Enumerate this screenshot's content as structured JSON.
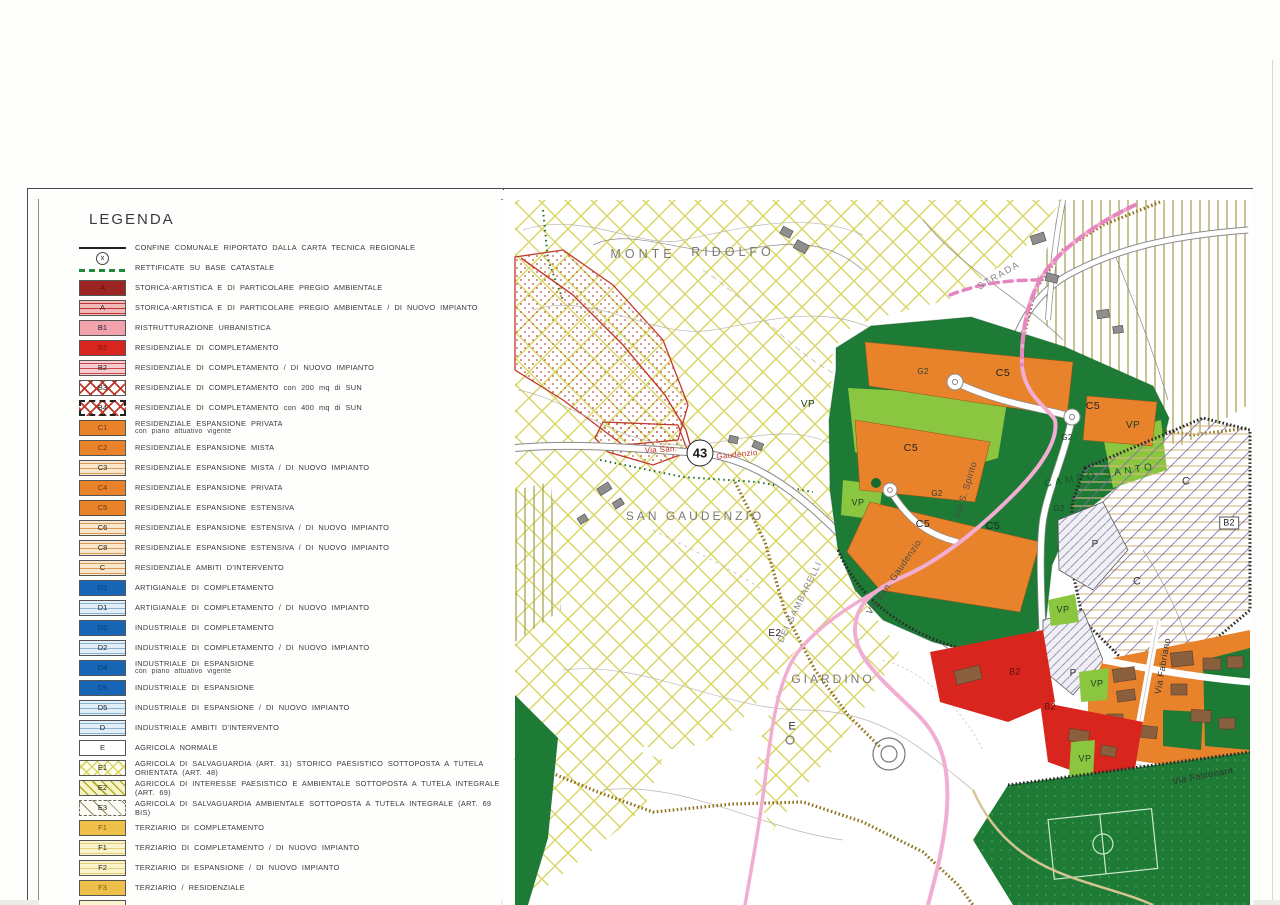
{
  "legend": {
    "title": "LEGENDA",
    "items": [
      {
        "code": "",
        "style": "line",
        "label": "CONFINE COMUNALE RIPORTATO DALLA CARTA TECNICA REGIONALE",
        "label2": ""
      },
      {
        "code": "x",
        "style": "dash-green",
        "label": "RETTIFICATE SU BASE CATASTALE",
        "label2": ""
      },
      {
        "code": "A",
        "style": "solid-darkred",
        "label": "STORICA-ARTISTICA E DI PARTICOLARE PREGIO AMBIENTALE",
        "label2": ""
      },
      {
        "code": "A",
        "style": "stripe-red",
        "label": "STORICA-ARTISTICA E DI PARTICOLARE PREGIO AMBIENTALE / DI NUOVO IMPIANTO",
        "label2": ""
      },
      {
        "code": "B1",
        "style": "solid-pink",
        "label": "RISTRUTTURAZIONE URBANISTICA",
        "label2": ""
      },
      {
        "code": "B2",
        "style": "solid-red",
        "label": "RESIDENZIALE DI COMPLETAMENTO",
        "label2": ""
      },
      {
        "code": "B2",
        "style": "stripe-pink",
        "label": "RESIDENZIALE DI COMPLETAMENTO / DI NUOVO IMPIANTO",
        "label2": ""
      },
      {
        "code": "B3",
        "style": "cross-red",
        "label": "RESIDENZIALE DI COMPLETAMENTO con 200 mq di SUN",
        "label2": ""
      },
      {
        "code": "B4",
        "style": "cross-red-border",
        "label": "RESIDENZIALE DI COMPLETAMENTO con 400 mq di SUN",
        "label2": ""
      },
      {
        "code": "C1",
        "style": "solid-orange",
        "label": "RESIDENZIALE ESPANSIONE PRIVATA",
        "label2": "con piano attuativo vigente"
      },
      {
        "code": "C2",
        "style": "solid-orange",
        "label": "RESIDENZIALE ESPANSIONE MISTA",
        "label2": ""
      },
      {
        "code": "C3",
        "style": "stripe-orange",
        "label": "RESIDENZIALE ESPANSIONE MISTA / DI NUOVO IMPIANTO",
        "label2": ""
      },
      {
        "code": "C4",
        "style": "solid-orange",
        "label": "RESIDENZIALE ESPANSIONE PRIVATA",
        "label2": ""
      },
      {
        "code": "C5",
        "style": "solid-orange",
        "label": "RESIDENZIALE ESPANSIONE ESTENSIVA",
        "label2": ""
      },
      {
        "code": "C6",
        "style": "stripe-orange",
        "label": "RESIDENZIALE ESPANSIONE ESTENSIVA / DI NUOVO IMPIANTO",
        "label2": ""
      },
      {
        "code": "C8",
        "style": "stripe-orange",
        "label": "RESIDENZIALE ESPANSIONE ESTENSIVA / DI NUOVO IMPIANTO",
        "label2": ""
      },
      {
        "code": "C",
        "style": "stripe-orange",
        "label": "RESIDENZIALE AMBITI D'INTERVENTO",
        "label2": ""
      },
      {
        "code": "D1",
        "style": "solid-blue",
        "label": "ARTIGIANALE DI COMPLETAMENTO",
        "label2": ""
      },
      {
        "code": "D1",
        "style": "stripe-blue",
        "label": "ARTIGIANALE DI COMPLETAMENTO / DI NUOVO IMPIANTO",
        "label2": ""
      },
      {
        "code": "D2",
        "style": "solid-blue",
        "label": "INDUSTRIALE DI COMPLETAMENTO",
        "label2": ""
      },
      {
        "code": "D2",
        "style": "stripe-blue",
        "label": "INDUSTRIALE DI COMPLETAMENTO / DI NUOVO IMPIANTO",
        "label2": ""
      },
      {
        "code": "D4",
        "style": "solid-blue",
        "label": "INDUSTRIALE DI ESPANSIONE",
        "label2": "con piano attuativo vigente"
      },
      {
        "code": "D5",
        "style": "solid-blue",
        "label": "INDUSTRIALE DI ESPANSIONE",
        "label2": ""
      },
      {
        "code": "D5",
        "style": "stripe-blue",
        "label": "INDUSTRIALE DI ESPANSIONE / DI NUOVO IMPIANTO",
        "label2": ""
      },
      {
        "code": "D",
        "style": "stripe-blue",
        "label": "INDUSTRIALE AMBITI D'INTERVENTO",
        "label2": ""
      },
      {
        "code": "E",
        "style": "solid-white",
        "label": "AGRICOLA NORMALE",
        "label2": ""
      },
      {
        "code": "E1",
        "style": "cross-yellow",
        "label": "AGRICOLA DI SALVAGUARDIA (ART. 31) STORICO PAESISTICO SOTTOPOSTA A TUTELA ORIENTATA (ART. 48)",
        "label2": ""
      },
      {
        "code": "E2",
        "style": "diag-yellow",
        "label": "AGRICOLA DI INTERESSE PAESISTICO E AMBIENTALE SOTTOPOSTA A TUTELA INTEGRALE (ART. 69)",
        "label2": ""
      },
      {
        "code": "E3",
        "style": "diag-sparse",
        "label": "AGRICOLA DI SALVAGUARDIA AMBIENTALE SOTTOPOSTA A TUTELA INTEGRALE (ART. 69 BIS)",
        "label2": ""
      },
      {
        "code": "F1",
        "style": "solid-amber",
        "label": "TERZIARIO DI COMPLETAMENTO",
        "label2": ""
      },
      {
        "code": "F1",
        "style": "stripe-amber",
        "label": "TERZIARIO DI COMPLETAMENTO / DI NUOVO IMPIANTO",
        "label2": ""
      },
      {
        "code": "F2",
        "style": "stripe-amber",
        "label": "TERZIARIO DI ESPANSIONE / DI NUOVO IMPIANTO",
        "label2": ""
      },
      {
        "code": "F3",
        "style": "solid-amber",
        "label": "TERZIARIO / RESIDENZIALE",
        "label2": ""
      },
      {
        "code": "",
        "style": "partial",
        "label": "",
        "label2": ""
      }
    ]
  },
  "map": {
    "labels": [
      {
        "text": "MONTE",
        "x": 140,
        "y": 64,
        "rot": 0,
        "size": 12.5,
        "ls": 4,
        "color": "#7c7a74",
        "cls": ""
      },
      {
        "text": "RIDOLFO",
        "x": 230,
        "y": 62,
        "rot": 0,
        "size": 12.5,
        "ls": 4,
        "color": "#7c7a74",
        "cls": ""
      },
      {
        "text": "SAN  GAUDENZIO",
        "x": 192,
        "y": 326,
        "rot": 0,
        "size": 12,
        "ls": 3,
        "color": "#7c7a74",
        "cls": ""
      },
      {
        "text": "GIARDINO",
        "x": 330,
        "y": 489,
        "rot": 0,
        "size": 12,
        "ls": 3,
        "color": "#7c7a74",
        "cls": ""
      },
      {
        "text": "STRADA",
        "x": 496,
        "y": 86,
        "rot": -30,
        "size": 9.5,
        "ls": 1.5,
        "color": "#8a8884",
        "cls": ""
      },
      {
        "text": "DEI  GAMBARELLI",
        "x": 297,
        "y": 412,
        "rot": -64,
        "size": 9,
        "ls": 1,
        "color": "#8a8884",
        "cls": ""
      },
      {
        "text": "Via San. Gaudenzio.",
        "x": 392,
        "y": 386,
        "rot": -55,
        "size": 9,
        "ls": 0.5,
        "color": "#4a4a48",
        "cls": ""
      },
      {
        "text": "Via S. Spirito",
        "x": 463,
        "y": 300,
        "rot": -73,
        "size": 9,
        "ls": 0.5,
        "color": "#4a4a48",
        "cls": ""
      },
      {
        "text": "Via Fabriano",
        "x": 660,
        "y": 476,
        "rot": -80,
        "size": 9,
        "ls": 0.5,
        "color": "#33332f",
        "cls": ""
      },
      {
        "text": "Via  Falconara",
        "x": 700,
        "y": 586,
        "rot": -11,
        "size": 9,
        "ls": 0.5,
        "color": "#33332f",
        "cls": ""
      },
      {
        "text": "CAMPO SANTO",
        "x": 597,
        "y": 286,
        "rot": -9,
        "size": 10,
        "ls": 3.5,
        "color": "#0f5c26",
        "cls": ""
      },
      {
        "text": "Via San.",
        "x": 158,
        "y": 260,
        "rot": -3,
        "size": 8,
        "ls": 0.3,
        "color": "#c03028",
        "cls": ""
      },
      {
        "text": "Gaudenzio",
        "x": 234,
        "y": 265,
        "rot": -6,
        "size": 8,
        "ls": 0.3,
        "color": "#c03028",
        "cls": ""
      },
      {
        "text": "43",
        "x": 197,
        "y": 263,
        "rot": 0,
        "size": 13,
        "ls": 0,
        "color": "#1a1a1a",
        "cls": "badge"
      },
      {
        "text": "C5",
        "x": 500,
        "y": 183,
        "rot": 0,
        "size": 10.5,
        "ls": 0.5,
        "color": "#222222",
        "cls": ""
      },
      {
        "text": "C5",
        "x": 590,
        "y": 216,
        "rot": 0,
        "size": 10.5,
        "ls": 0.5,
        "color": "#222222",
        "cls": ""
      },
      {
        "text": "C5",
        "x": 408,
        "y": 258,
        "rot": 0,
        "size": 10.5,
        "ls": 0.5,
        "color": "#222222",
        "cls": ""
      },
      {
        "text": "C5",
        "x": 420,
        "y": 334,
        "rot": 0,
        "size": 10.5,
        "ls": 0.5,
        "color": "#222222",
        "cls": ""
      },
      {
        "text": "C5",
        "x": 490,
        "y": 336,
        "rot": 0,
        "size": 10.5,
        "ls": 0.5,
        "color": "#222222",
        "cls": ""
      },
      {
        "text": "VP",
        "x": 305,
        "y": 215,
        "rot": 0,
        "size": 10,
        "ls": 0.5,
        "color": "#1d3a22",
        "cls": ""
      },
      {
        "text": "VP",
        "x": 630,
        "y": 236,
        "rot": 0,
        "size": 10,
        "ls": 0.5,
        "color": "#1d3a22",
        "cls": ""
      },
      {
        "text": "VP",
        "x": 355,
        "y": 313,
        "rot": 0,
        "size": 9,
        "ls": 0.5,
        "color": "#1d3a22",
        "cls": ""
      },
      {
        "text": "VP",
        "x": 560,
        "y": 420,
        "rot": 0,
        "size": 9,
        "ls": 0.5,
        "color": "#1d3a22",
        "cls": ""
      },
      {
        "text": "VP",
        "x": 594,
        "y": 494,
        "rot": 0,
        "size": 9,
        "ls": 0.5,
        "color": "#1d3a22",
        "cls": ""
      },
      {
        "text": "VP",
        "x": 582,
        "y": 569,
        "rot": 0,
        "size": 9,
        "ls": 0.5,
        "color": "#1d3a22",
        "cls": ""
      },
      {
        "text": "G2",
        "x": 420,
        "y": 182,
        "rot": 0,
        "size": 8,
        "ls": 0.3,
        "color": "#25402a",
        "cls": ""
      },
      {
        "text": "G2",
        "x": 564,
        "y": 248,
        "rot": 0,
        "size": 8,
        "ls": 0.3,
        "color": "#25402a",
        "cls": ""
      },
      {
        "text": "G2",
        "x": 434,
        "y": 304,
        "rot": 0,
        "size": 8,
        "ls": 0.3,
        "color": "#25402a",
        "cls": ""
      },
      {
        "text": "G2",
        "x": 556,
        "y": 319,
        "rot": 0,
        "size": 8,
        "ls": 0.3,
        "color": "#25402a",
        "cls": ""
      },
      {
        "text": "P",
        "x": 592,
        "y": 355,
        "rot": 0,
        "size": 10,
        "ls": 0,
        "color": "#333333",
        "cls": ""
      },
      {
        "text": "P",
        "x": 570,
        "y": 484,
        "rot": 0,
        "size": 10,
        "ls": 0,
        "color": "#333333",
        "cls": ""
      },
      {
        "text": "C",
        "x": 683,
        "y": 292,
        "rot": 0,
        "size": 11,
        "ls": 0,
        "color": "#333333",
        "cls": ""
      },
      {
        "text": "C",
        "x": 634,
        "y": 392,
        "rot": 0,
        "size": 11,
        "ls": 0,
        "color": "#333333",
        "cls": ""
      },
      {
        "text": "B2",
        "x": 512,
        "y": 482,
        "rot": 0,
        "size": 9,
        "ls": 0.3,
        "color": "#5c1410",
        "cls": ""
      },
      {
        "text": "B2",
        "x": 547,
        "y": 517,
        "rot": 0,
        "size": 9,
        "ls": 0.3,
        "color": "#5c1410",
        "cls": ""
      },
      {
        "text": "B2",
        "x": 726,
        "y": 333,
        "rot": 0,
        "size": 9,
        "ls": 0.3,
        "color": "#222222",
        "cls": "boxed"
      },
      {
        "text": "E2",
        "x": 272,
        "y": 444,
        "rot": 0,
        "size": 10,
        "ls": 0.5,
        "color": "#222222",
        "cls": ""
      },
      {
        "text": "E",
        "x": 289,
        "y": 537,
        "rot": 0,
        "size": 11,
        "ls": 0,
        "color": "#333333",
        "cls": ""
      }
    ]
  },
  "colors": {
    "crosshatch": "#d9d561",
    "vertical_hatch": "#a9a457",
    "dark_green": "#1d7b35",
    "light_green": "#8ac640",
    "orange": "#e8832c",
    "red_zone": "#d8251d",
    "pink_road": "#f2aed2",
    "brown_road": "#8f741f",
    "blue": "#1766b5",
    "amber": "#eec04a"
  }
}
